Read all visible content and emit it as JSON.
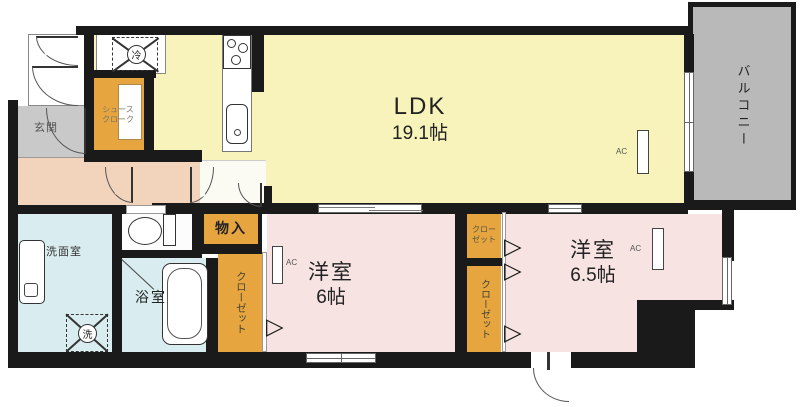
{
  "floorplan": {
    "rooms": {
      "ldk": {
        "name": "LDK",
        "size": "19.1帖"
      },
      "balcony": {
        "name": "バルコニー"
      },
      "bedroom1": {
        "name": "洋室",
        "size": "6帖"
      },
      "bedroom2": {
        "name": "洋室",
        "size": "6.5帖"
      },
      "washroom": {
        "name": "洗面室"
      },
      "bathroom": {
        "name": "浴室"
      },
      "entrance": {
        "name": "玄関"
      },
      "shoe_closet": {
        "line1": "シュース",
        "line2": "クローク"
      },
      "storage": {
        "name": "物入"
      },
      "closet_bedroom1": {
        "name": "クローゼット"
      },
      "closet_bedroom2_small": {
        "line1": "クロー",
        "line2": "ゼット"
      },
      "closet_bedroom2_tall": {
        "name": "クローゼット"
      }
    },
    "appliances": {
      "washer": "洗",
      "refrigerator": "冷",
      "air_conditioner": "AC"
    },
    "icons": {
      "folding_door_arrow": "▷"
    },
    "colors": {
      "ldk_floor": "#f7f3ba",
      "bedroom_floor": "#f6e3e2",
      "hallway_floor": "#f2d3bb",
      "wet_area_floor": "#d9edf0",
      "closet_fill": "#e6a53f",
      "balcony_fill": "#b9b9b9",
      "entrance_fill": "#c9c9c9",
      "wall": "#1a1a1a"
    }
  }
}
